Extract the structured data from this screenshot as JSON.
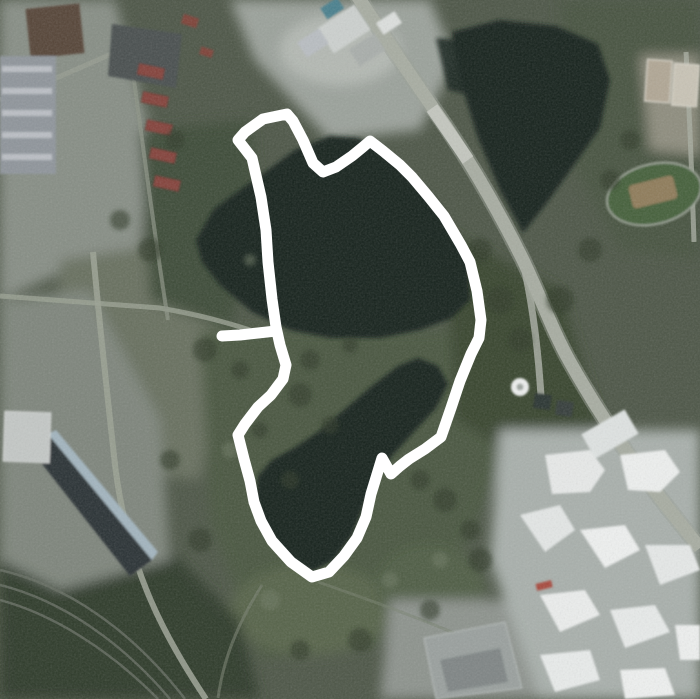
{
  "map": {
    "kind": "satellite-route-map",
    "description": "Aerial satellite view of a park with lakes; a white GPS activity track forms a loop around the lakes with a short out-and-back spur on the west side.",
    "colors": {
      "route": "#ffffff",
      "water": "#18211d",
      "road": "#a8ada2",
      "terrain_base": "#4d5647",
      "forest": "#33402e",
      "building_white": "#e9ebea",
      "building_dark": "#2d3338",
      "roof_red": "#84433a"
    },
    "route": {
      "stroke_width": 11,
      "color": "#ffffff",
      "loop_points": [
        [
          287,
          114
        ],
        [
          293,
          121
        ],
        [
          303,
          140
        ],
        [
          313,
          163
        ],
        [
          323,
          172
        ],
        [
          336,
          167
        ],
        [
          352,
          156
        ],
        [
          363,
          147
        ],
        [
          370,
          141
        ],
        [
          383,
          151
        ],
        [
          400,
          165
        ],
        [
          412,
          177
        ],
        [
          428,
          196
        ],
        [
          444,
          216
        ],
        [
          461,
          245
        ],
        [
          470,
          262
        ],
        [
          477,
          291
        ],
        [
          481,
          320
        ],
        [
          479,
          338
        ],
        [
          471,
          354
        ],
        [
          460,
          381
        ],
        [
          451,
          408
        ],
        [
          441,
          437
        ],
        [
          425,
          449
        ],
        [
          409,
          459
        ],
        [
          400,
          466
        ],
        [
          391,
          474
        ],
        [
          382,
          458
        ],
        [
          371,
          494
        ],
        [
          366,
          517
        ],
        [
          357,
          538
        ],
        [
          344,
          556
        ],
        [
          329,
          572
        ],
        [
          312,
          577
        ],
        [
          291,
          562
        ],
        [
          272,
          541
        ],
        [
          261,
          521
        ],
        [
          254,
          502
        ],
        [
          250,
          481
        ],
        [
          244,
          459
        ],
        [
          238,
          435
        ],
        [
          245,
          424
        ],
        [
          258,
          407
        ],
        [
          271,
          395
        ],
        [
          283,
          379
        ],
        [
          286,
          365
        ],
        [
          280,
          345
        ],
        [
          276,
          327
        ],
        [
          272,
          299
        ],
        [
          268,
          262
        ],
        [
          266,
          230
        ],
        [
          261,
          197
        ],
        [
          252,
          158
        ],
        [
          238,
          140
        ],
        [
          245,
          132
        ],
        [
          263,
          119
        ],
        [
          287,
          114
        ]
      ],
      "spur_points": [
        [
          276,
          331
        ],
        [
          258,
          333
        ],
        [
          240,
          335
        ],
        [
          222,
          336
        ]
      ]
    }
  }
}
